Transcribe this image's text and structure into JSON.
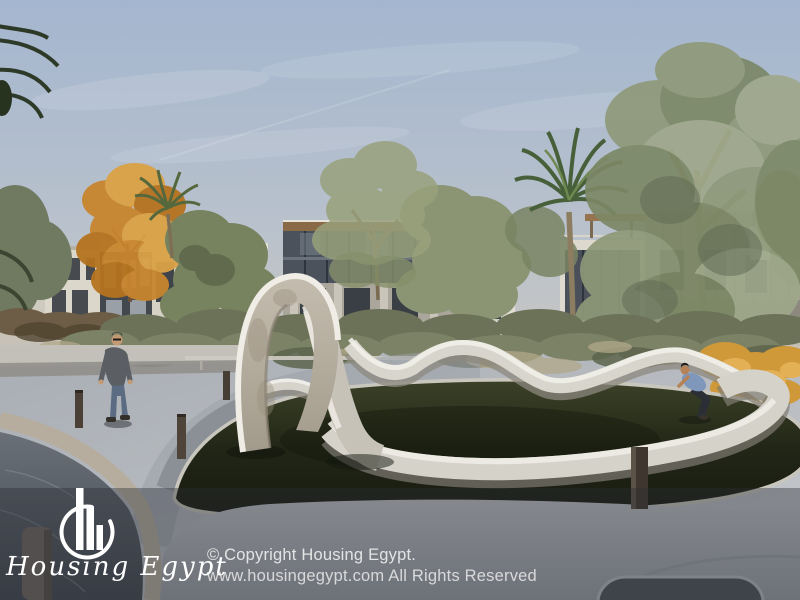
{
  "watermark": {
    "brand": "Housing Egypt",
    "logo_icon": "housing-egypt-circle-bars-logo",
    "copyright_line1": "© Copyright Housing Egypt.",
    "copyright_line2": "www.housingegypt.com All Rights Reserved"
  },
  "palette": {
    "sky_top": "#a6b7cf",
    "sky_horizon": "#c9c7c2",
    "lawn": "#232819",
    "path": "#b9bec3",
    "water": "#5c636c",
    "sculpture": "#e7e4dd",
    "autumn_tree": "#c8862e",
    "olive_tree": "#7c8767",
    "yellow_shrub": "#cf9838",
    "overlay": "rgba(42,46,52,0.40)"
  },
  "scene": {
    "description": "3D architectural render of a residential compound: modern villas, palm trees, a white wave sculpture on a circular lawn beside a curved waterside promenade",
    "objects": [
      "sky",
      "modern-villas",
      "palm-trees",
      "autumn-tree",
      "hedge",
      "wave-sculpture",
      "circular-lawn",
      "promenade-path",
      "water-canal",
      "walking-man",
      "reclining-woman",
      "bollard-lights"
    ]
  }
}
